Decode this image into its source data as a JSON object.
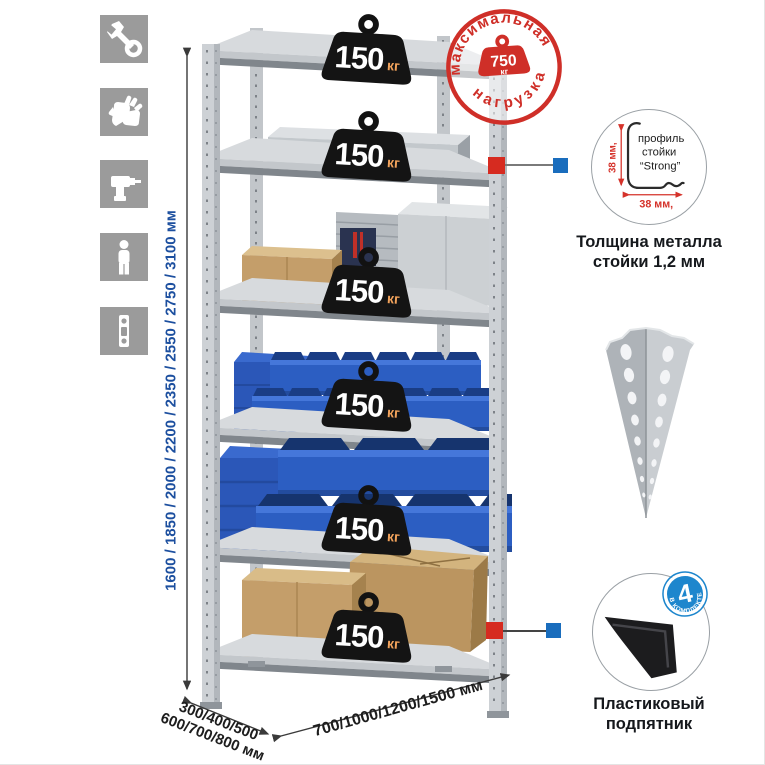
{
  "sidebar": {
    "icons": [
      {
        "name": "wrench-icon"
      },
      {
        "name": "gloves-icon"
      },
      {
        "name": "drill-icon"
      },
      {
        "name": "person-icon"
      },
      {
        "name": "spirit-level-icon"
      }
    ]
  },
  "dimensions": {
    "height_label": "1600 / 1850 / 2000 / 2200 / 2350 / 2550 / 2750 / 3100 мм",
    "depth_label_line1": "300/400/500",
    "depth_label_line2": "600/700/800 мм",
    "width_label": "700/1000/1200/1500 мм"
  },
  "max_load_stamp": {
    "top_text": "максимальная",
    "bottom_text": "нагрузка",
    "value": "750",
    "unit": "кг"
  },
  "shelf_loads": [
    {
      "value": "150",
      "unit": "кг"
    },
    {
      "value": "150",
      "unit": "кг"
    },
    {
      "value": "150",
      "unit": "кг"
    },
    {
      "value": "150",
      "unit": "кг"
    },
    {
      "value": "150",
      "unit": "кг"
    },
    {
      "value": "150",
      "unit": "кг"
    }
  ],
  "profile_detail": {
    "line1": "профиль",
    "line2": "стойки",
    "line3": "“Strong”",
    "height_dim": "38 мм,",
    "width_dim": "38 мм,",
    "caption_line1": "Толщина металла",
    "caption_line2": "стойки 1,2 мм"
  },
  "foot_detail": {
    "badge_number": "4",
    "badge_text": "В КОМПЛЕКТЕ",
    "caption_line1": "Пластиковый",
    "caption_line2": "подпятник"
  },
  "colors": {
    "accent_red": "#d0312a",
    "dim_blue": "#1c4f9f",
    "marker_red": "#d62b20",
    "marker_blue": "#1a6dbd",
    "bin_blue": "#2c5ec2",
    "badge_blue": "#1d86cd",
    "icon_gray": "#9b9b9b",
    "metal_gray": "#cdd1d5"
  }
}
